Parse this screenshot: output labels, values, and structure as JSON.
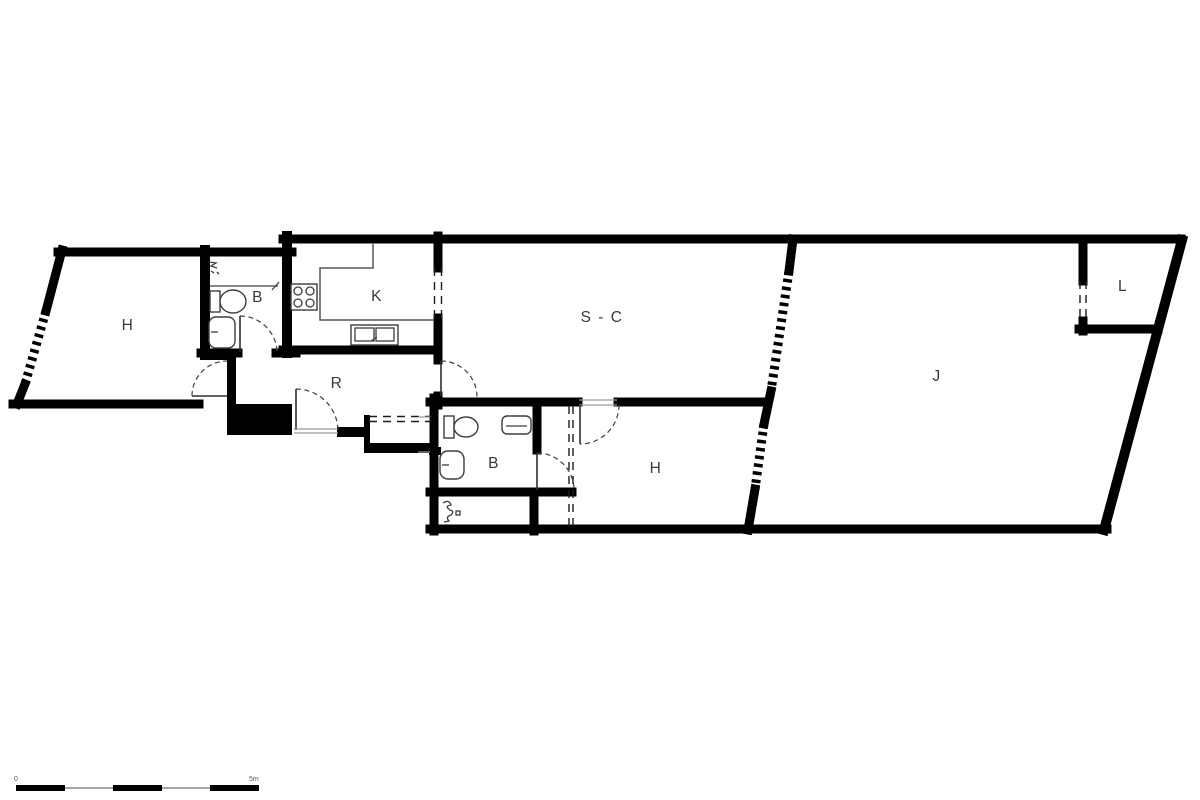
{
  "colors": {
    "background": "#ffffff",
    "wall": "#000000",
    "fixture": "#3d3d3d",
    "label": "#3a3a3a"
  },
  "plan": {
    "rooms": [
      {
        "id": "hall-upper-left",
        "label": "H",
        "x": 128,
        "y": 330
      },
      {
        "id": "bathroom-upper",
        "label": "B",
        "x": 258,
        "y": 302
      },
      {
        "id": "kitchen",
        "label": "K",
        "x": 377,
        "y": 301
      },
      {
        "id": "corridor",
        "label": "R",
        "x": 337,
        "y": 388
      },
      {
        "id": "living-room",
        "label": "S - C",
        "x": 602,
        "y": 322
      },
      {
        "id": "bathroom-lower",
        "label": "B",
        "x": 494,
        "y": 468
      },
      {
        "id": "hall-lower",
        "label": "H",
        "x": 656,
        "y": 473
      },
      {
        "id": "garden",
        "label": "J",
        "x": 937,
        "y": 381
      },
      {
        "id": "storage",
        "label": "L",
        "x": 1123,
        "y": 291
      }
    ],
    "scale_bar": {
      "label_start": "0",
      "label_end": "5m"
    }
  }
}
